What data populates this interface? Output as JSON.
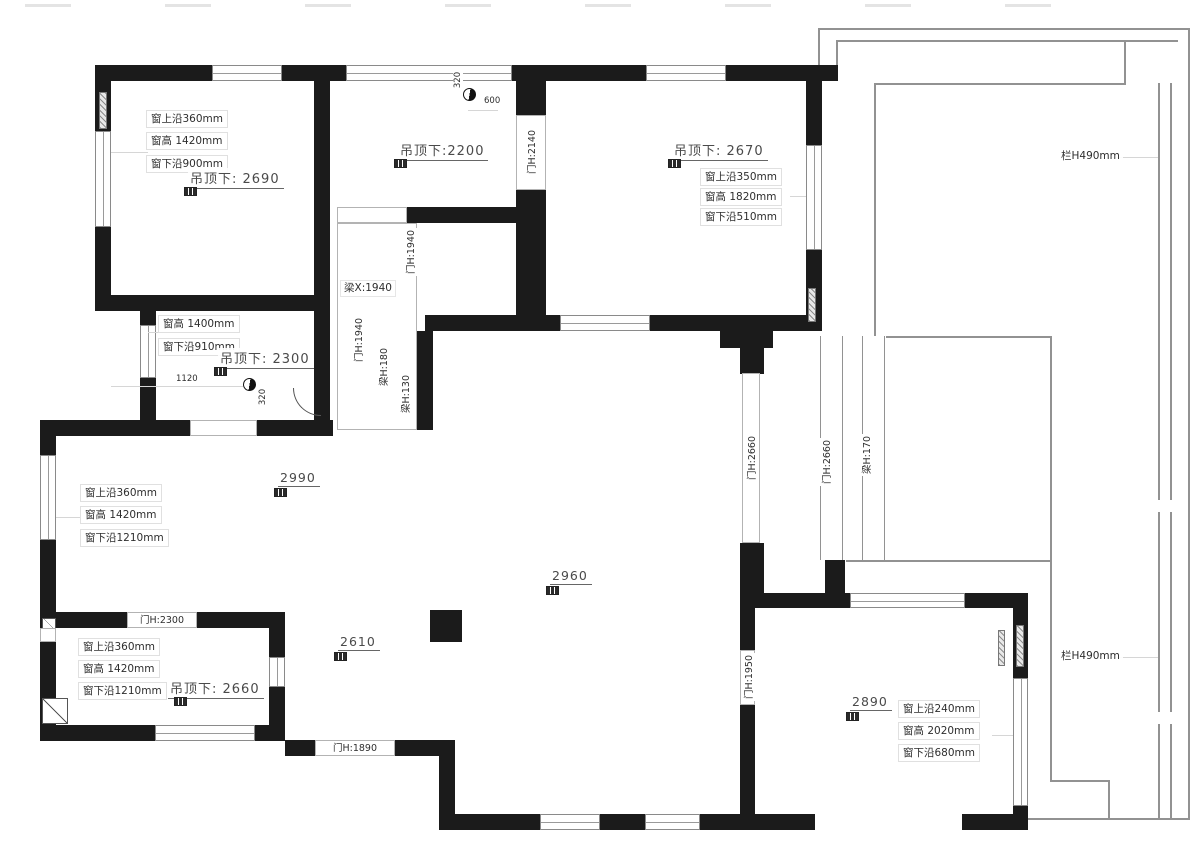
{
  "plan": {
    "room_a": {
      "ceiling": "吊顶下: 2690",
      "win_top": "窗上沿360mm",
      "win_height": "窗高 1420mm",
      "win_sill": "窗下沿900mm"
    },
    "room_b": {
      "ceiling": "吊顶下:2200",
      "dim_offset": "320",
      "dim_diameter": "600",
      "door": "门H:2140"
    },
    "room_c": {
      "ceiling": "吊顶下: 2670",
      "win_top": "窗上沿350mm",
      "win_height": "窗高 1820mm",
      "win_sill": "窗下沿510mm"
    },
    "room_d": {
      "ceiling": "吊顶下: 2300",
      "win_height": "窗高 1400mm",
      "win_sill": "窗下沿910mm",
      "dim_width": "1120",
      "dim_offset": "320"
    },
    "corridor": {
      "beam": "梁X:1940",
      "door_top": "门H:1940",
      "door": "门H:1940",
      "beam_h180": "梁H:180",
      "beam_h130": "梁H:130"
    },
    "living": {
      "h1": "2990",
      "h2": "2960",
      "h3": "2610",
      "win_top": "窗上沿360mm",
      "win_height": "窗高 1420mm",
      "win_sill": "窗下沿1210mm"
    },
    "room_e": {
      "ceiling": "吊顶下: 2660",
      "door": "门H:2300",
      "win_top": "窗上沿360mm",
      "win_height": "窗高 1420mm",
      "win_sill": "窗下沿1210mm"
    },
    "bottom_door": "门H:1890",
    "right_corridor": {
      "door1": "门H:2660",
      "door2": "门H:2660",
      "beam": "梁H:170",
      "door3": "门H:1950"
    },
    "room_f": {
      "h": "2890",
      "win_top": "窗上沿240mm",
      "win_height": "窗高 2020mm",
      "win_sill": "窗下沿680mm"
    },
    "balcony": {
      "rail_top": "栏H490mm",
      "rail_bottom": "栏H490mm"
    }
  },
  "colors": {
    "wall": "#1b1b1b",
    "balcony_line": "#929292",
    "text": "#2e2e2e"
  }
}
